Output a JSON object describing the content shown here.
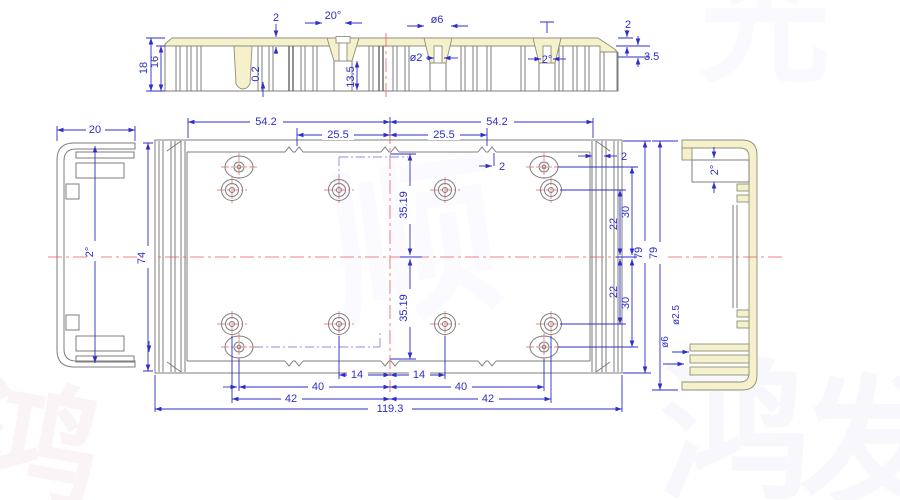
{
  "title": "enclosure-extrusion-engineering-drawing",
  "colors": {
    "background": "#ffffff",
    "outline_gray": "#7d7d7d",
    "dimension_blue": "#2e2ec8",
    "section_fill_yellow": "#f6f1cd",
    "centerline_red": "#f05a5a"
  },
  "watermark": {
    "items": [
      {
        "char": "顺"
      },
      {
        "char": "鸿"
      },
      {
        "char": "发"
      },
      {
        "char": "鸿"
      },
      {
        "char": "光"
      }
    ]
  },
  "views": {
    "top_section": {
      "dims": {
        "height": "18",
        "inner_height": "16",
        "top_wall": "2",
        "slot_angle": "20°",
        "step": "0.2",
        "slot_depth": "13.5",
        "hole_small": "ø2",
        "hole_large": "ø6",
        "boss_slot": "2°",
        "end_wall": "2",
        "end_step": "3.5"
      }
    },
    "plan": {
      "dims": {
        "w_54_left": "54.2",
        "w_54_right": "54.2",
        "w_255_left": "25.5",
        "w_255_right": "25.5",
        "notch_width": "2",
        "wall_width": "2",
        "height_inner": "74",
        "v35_top": "35.19",
        "v35_bottom": "35.19",
        "v22_top": "22",
        "v22_bottom": "22",
        "v30_top": "30",
        "v30_bottom": "30",
        "height_overall": "79",
        "b14_left": "14",
        "b14_right": "14",
        "b40_left": "40",
        "b40_right": "40",
        "b42_left": "42",
        "b42_right": "42",
        "width_overall": "119.3"
      }
    },
    "left_side": {
      "dims": {
        "width": "20",
        "draft_angle": "2°"
      }
    },
    "right_side": {
      "dims": {
        "height": "79",
        "draft_angle": "2°",
        "slot_small": "ø2.5",
        "slot_large": "ø6"
      }
    }
  }
}
